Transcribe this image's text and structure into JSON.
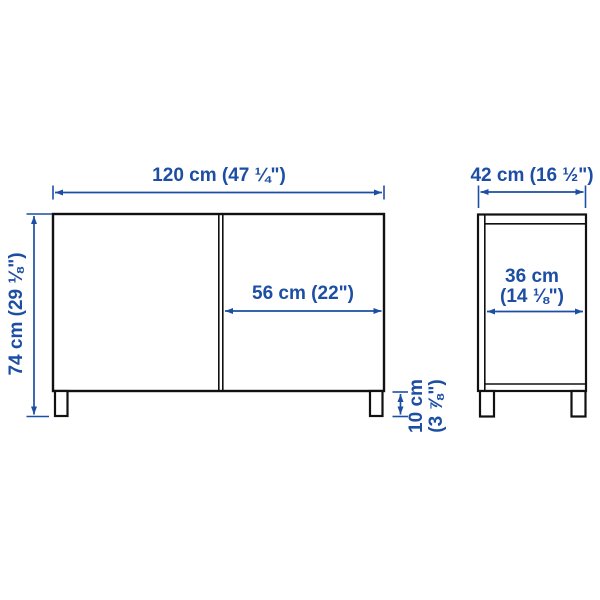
{
  "colors": {
    "dimension": "#1c4ea3",
    "outline": "#111111",
    "background": "#ffffff"
  },
  "front_view": {
    "width_label": "120 cm (47 ¼\")",
    "height_label": "74 cm (29 ⅛\")",
    "door_width_label": "56 cm (22\")",
    "leg_height_label_line1": "10 cm",
    "leg_height_label_line2": "(3 ⅞\")"
  },
  "side_view": {
    "depth_label": "42 cm (16 ½\")",
    "inner_depth_label_line1": "36 cm",
    "inner_depth_label_line2": "(14 ⅛\")"
  }
}
